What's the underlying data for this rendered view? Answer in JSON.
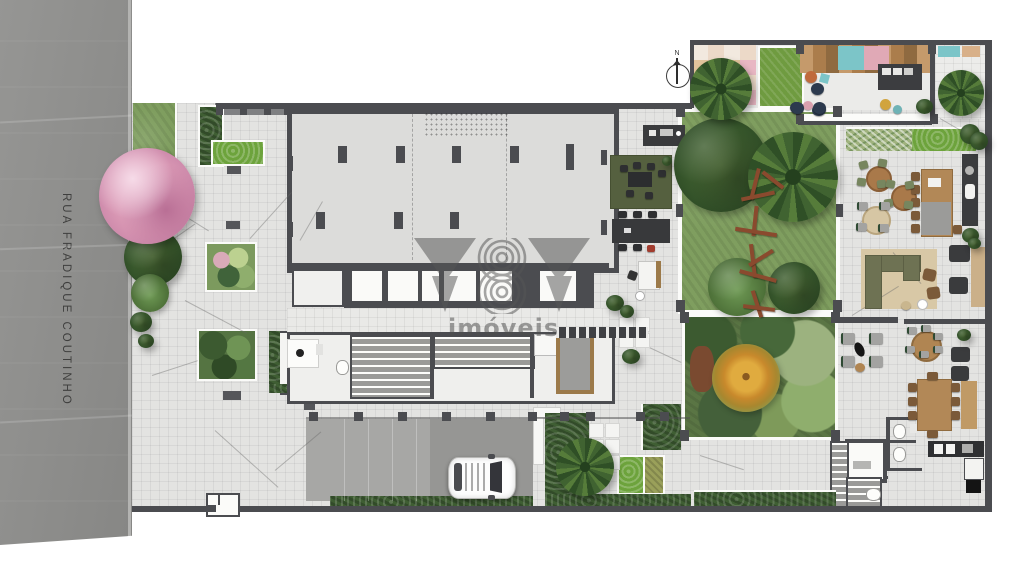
{
  "street": {
    "label": "RUA FRADIQUE COUTINHO"
  },
  "compass": {
    "label": "N"
  },
  "watermark": {
    "brand": "YBY",
    "suffix": "imóveis"
  },
  "palette": {
    "street": "#8f8f8d",
    "paving": "#e3e3e1",
    "slab": "#dcdcda",
    "wall": "#4b4c50",
    "lawn": "#7f9e5f",
    "lawn_bright": "#6f9b40",
    "hedge": "#3f5e33",
    "garden_accent_tree": "#d9a139",
    "blossom_tree": "#dfa3bd",
    "wood_furniture": "#b28857",
    "rug_olive": "#55603f",
    "rug_beige": "#d8c8a6",
    "deck_teal": "#7cc5c8",
    "mat_pink": "#e0a9b6",
    "beanbag_navy": "#2c3a4e",
    "car_body": "#fdfdfd"
  }
}
